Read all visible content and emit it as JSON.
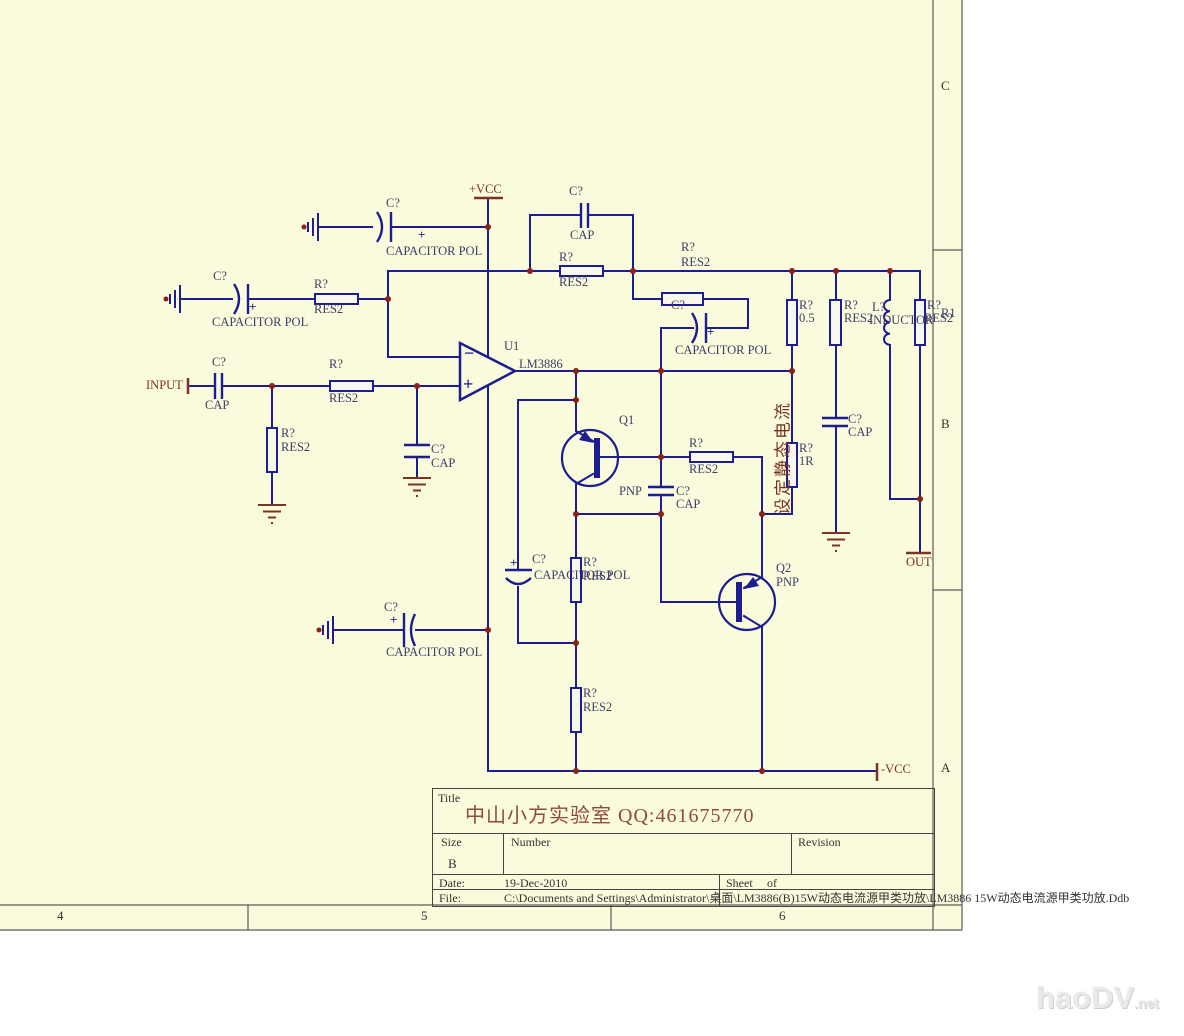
{
  "sheet": {
    "background": "#fafadc",
    "row_markers": [
      "C",
      "B",
      "A"
    ],
    "column_markers": [
      "4",
      "5",
      "6"
    ]
  },
  "colors": {
    "wire": "#1d1d8f",
    "junction_dot": "#8b2015",
    "component_text": "#3e3e68",
    "port_text": "#7c3322",
    "title_text": "#8f4a3e",
    "sheet_bg": "#fafadc",
    "border": "#5a5a5a"
  },
  "annotation": "设定静态电流",
  "title_block": {
    "title_label": "Title",
    "title": "中山小方实验室  QQ:461675770",
    "size_label": "Size",
    "size": "B",
    "number_label": "Number",
    "revision_label": "Revision",
    "date_label": "Date:",
    "date": "19-Dec-2010",
    "sheet_label": "Sheet",
    "of_label": "of",
    "file_label": "File:",
    "file_path": "C:\\Documents and Settings\\Administrator\\桌面\\LM3886(B)15W动态电流源甲类功放\\LM3886 15W动态电流源甲类功放.Ddb"
  },
  "watermark": {
    "text": "haoDV",
    "suffix": ".net"
  },
  "labels": [
    {
      "t": "C?",
      "x": 386,
      "y": 197,
      "n": "cap-pol-top-designator"
    },
    {
      "t": "CAPACITOR POL",
      "x": 386,
      "y": 245,
      "n": "cap-pol-top-type"
    },
    {
      "t": "+VCC",
      "x": 469,
      "y": 183,
      "c": "m",
      "n": "vcc-port-label"
    },
    {
      "t": "C?",
      "x": 569,
      "y": 185,
      "n": "feedback-cap-designator"
    },
    {
      "t": "CAP",
      "x": 570,
      "y": 229,
      "n": "feedback-cap-type"
    },
    {
      "t": "R?",
      "x": 559,
      "y": 251,
      "n": "feedback-res-designator"
    },
    {
      "t": "RES2",
      "x": 559,
      "y": 276,
      "n": "feedback-res-type"
    },
    {
      "t": "R?",
      "x": 681,
      "y": 241,
      "n": "fb-network-res-designator"
    },
    {
      "t": "RES2",
      "x": 681,
      "y": 256,
      "n": "fb-network-res-type"
    },
    {
      "t": "C?",
      "x": 671,
      "y": 299,
      "n": "fb-cap-pol-designator"
    },
    {
      "t": "CAPACITOR POL",
      "x": 675,
      "y": 344,
      "n": "fb-cap-pol-type"
    },
    {
      "t": "C?",
      "x": 213,
      "y": 270,
      "n": "inv-cap-pol-designator"
    },
    {
      "t": "CAPACITOR POL",
      "x": 212,
      "y": 316,
      "n": "inv-cap-pol-type"
    },
    {
      "t": "R?",
      "x": 314,
      "y": 278,
      "n": "inv-res-designator"
    },
    {
      "t": "RES2",
      "x": 314,
      "y": 303,
      "n": "inv-res-type"
    },
    {
      "t": "INPUT",
      "x": 146,
      "y": 379,
      "c": "m",
      "n": "input-port-label"
    },
    {
      "t": "C?",
      "x": 212,
      "y": 356,
      "n": "input-cap-designator"
    },
    {
      "t": "CAP",
      "x": 205,
      "y": 399,
      "n": "input-cap-type"
    },
    {
      "t": "R?",
      "x": 329,
      "y": 358,
      "n": "input-res-designator"
    },
    {
      "t": "RES2",
      "x": 329,
      "y": 392,
      "n": "input-res-type"
    },
    {
      "t": "R?",
      "x": 281,
      "y": 427,
      "n": "shunt-res-designator"
    },
    {
      "t": "RES2",
      "x": 281,
      "y": 441,
      "n": "shunt-res-type"
    },
    {
      "t": "C?",
      "x": 431,
      "y": 443,
      "n": "shunt-cap-designator"
    },
    {
      "t": "CAP",
      "x": 431,
      "y": 457,
      "n": "shunt-cap-type"
    },
    {
      "t": "U1",
      "x": 504,
      "y": 340,
      "n": "opamp-designator"
    },
    {
      "t": "LM3886",
      "x": 519,
      "y": 358,
      "n": "opamp-part-number"
    },
    {
      "t": "Q1",
      "x": 619,
      "y": 414,
      "n": "q1-designator"
    },
    {
      "t": "PNP",
      "x": 619,
      "y": 485,
      "n": "q1-type"
    },
    {
      "t": "C?",
      "x": 676,
      "y": 485,
      "n": "base-cap-designator"
    },
    {
      "t": "CAP",
      "x": 676,
      "y": 498,
      "n": "base-cap-type"
    },
    {
      "t": "R?",
      "x": 689,
      "y": 437,
      "n": "base-res-designator"
    },
    {
      "t": "RES2",
      "x": 689,
      "y": 463,
      "n": "base-res-type"
    },
    {
      "t": "R?",
      "x": 799,
      "y": 299,
      "n": "sense-res-designator"
    },
    {
      "t": "0.5",
      "x": 799,
      "y": 312,
      "n": "sense-res-value"
    },
    {
      "t": "R?",
      "x": 844,
      "y": 299,
      "n": "out-res2-designator"
    },
    {
      "t": "RES2",
      "x": 844,
      "y": 312,
      "n": "out-res2-type"
    },
    {
      "t": "L?",
      "x": 872,
      "y": 301,
      "n": "inductor-designator"
    },
    {
      "t": "INDUCTOR",
      "x": 869,
      "y": 314,
      "n": "inductor-type"
    },
    {
      "t": "R?",
      "x": 927,
      "y": 299,
      "n": "out-res3-designator"
    },
    {
      "t": "RES2",
      "x": 924,
      "y": 312,
      "n": "out-res3-type"
    },
    {
      "t": "R1",
      "x": 941,
      "y": 307,
      "n": "out-res3-alt-name"
    },
    {
      "t": "R?",
      "x": 799,
      "y": 442,
      "n": "r1r-designator"
    },
    {
      "t": "1R",
      "x": 799,
      "y": 455,
      "n": "r1r-value"
    },
    {
      "t": "C?",
      "x": 848,
      "y": 413,
      "n": "out-cap-designator"
    },
    {
      "t": "CAP",
      "x": 848,
      "y": 426,
      "n": "out-cap-type"
    },
    {
      "t": "C?",
      "x": 532,
      "y": 553,
      "n": "boot-cap-pol-designator"
    },
    {
      "t": "CAPACITOR POL",
      "x": 534,
      "y": 569,
      "n": "boot-cap-pol-type"
    },
    {
      "t": "R?",
      "x": 583,
      "y": 556,
      "n": "divider-res1-designator"
    },
    {
      "t": "RES2",
      "x": 583,
      "y": 570,
      "n": "divider-res1-type"
    },
    {
      "t": "Q2",
      "x": 776,
      "y": 562,
      "n": "q2-designator"
    },
    {
      "t": "PNP",
      "x": 776,
      "y": 576,
      "n": "q2-type"
    },
    {
      "t": "R?",
      "x": 583,
      "y": 687,
      "n": "divider-res2-designator"
    },
    {
      "t": "RES2",
      "x": 583,
      "y": 701,
      "n": "divider-res2-type"
    },
    {
      "t": "C?",
      "x": 384,
      "y": 601,
      "n": "neg-rail-cap-designator"
    },
    {
      "t": "CAPACITOR POL",
      "x": 386,
      "y": 646,
      "n": "neg-rail-cap-type"
    },
    {
      "t": "-VCC",
      "x": 881,
      "y": 763,
      "c": "m",
      "n": "neg-vcc-port-label"
    },
    {
      "t": "OUT",
      "x": 906,
      "y": 556,
      "c": "m",
      "n": "out-port-label"
    },
    {
      "t": "−",
      "x": 464,
      "y": 344,
      "c": "w",
      "s": 18,
      "n": "opamp-inverting-mark"
    },
    {
      "t": "+",
      "x": 463,
      "y": 375,
      "c": "w",
      "s": 18,
      "n": "opamp-noninverting-mark"
    },
    {
      "t": "+",
      "x": 418,
      "y": 228,
      "c": "w",
      "s": 13,
      "n": "polarity-plus-mark"
    },
    {
      "t": "+",
      "x": 249,
      "y": 300,
      "c": "w",
      "s": 13,
      "n": "polarity-plus-mark"
    },
    {
      "t": "+",
      "x": 707,
      "y": 325,
      "c": "w",
      "s": 13,
      "n": "polarity-plus-mark"
    },
    {
      "t": "+",
      "x": 510,
      "y": 556,
      "c": "w",
      "s": 13,
      "n": "polarity-plus-mark"
    },
    {
      "t": "+",
      "x": 390,
      "y": 613,
      "c": "w",
      "s": 13,
      "n": "polarity-plus-mark"
    },
    {
      "t": "C",
      "x": 941,
      "y": 79,
      "c": "b",
      "s": 13,
      "n": "row-marker-c"
    },
    {
      "t": "B",
      "x": 941,
      "y": 417,
      "c": "b",
      "s": 13,
      "n": "row-marker-b"
    },
    {
      "t": "A",
      "x": 941,
      "y": 761,
      "c": "b",
      "s": 13,
      "n": "row-marker-a"
    },
    {
      "t": "4",
      "x": 57,
      "y": 909,
      "c": "b",
      "s": 13,
      "n": "column-marker-4"
    },
    {
      "t": "5",
      "x": 421,
      "y": 909,
      "c": "b",
      "s": 13,
      "n": "column-marker-5"
    },
    {
      "t": "6",
      "x": 779,
      "y": 909,
      "c": "b",
      "s": 13,
      "n": "column-marker-6"
    }
  ]
}
